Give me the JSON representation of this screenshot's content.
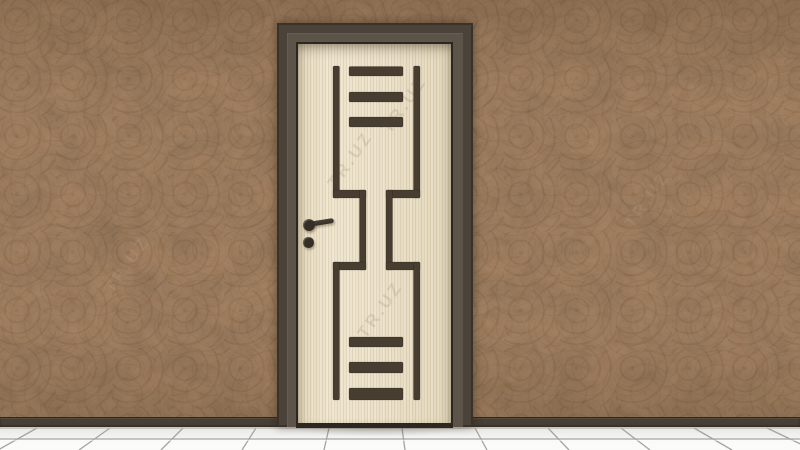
{
  "colors": {
    "wall_base": "#9c744e",
    "wall_shadow": "#6f5134",
    "wall_highlight": "#b48c60",
    "frame": "#4b433a",
    "frame_bevel": "#5d5449",
    "frame_edge": "#2d2721",
    "door_base": "#eadfc6",
    "door_grain": "#d8cbab",
    "inlay": "#473d31",
    "baseboard": "#473e35",
    "floor_light": "#fbfbfa",
    "floor_shade": "#e6e6e3",
    "grout": "#a5a49f",
    "handle": "#352e26"
  },
  "watermark": {
    "text": "TR.UZ"
  }
}
